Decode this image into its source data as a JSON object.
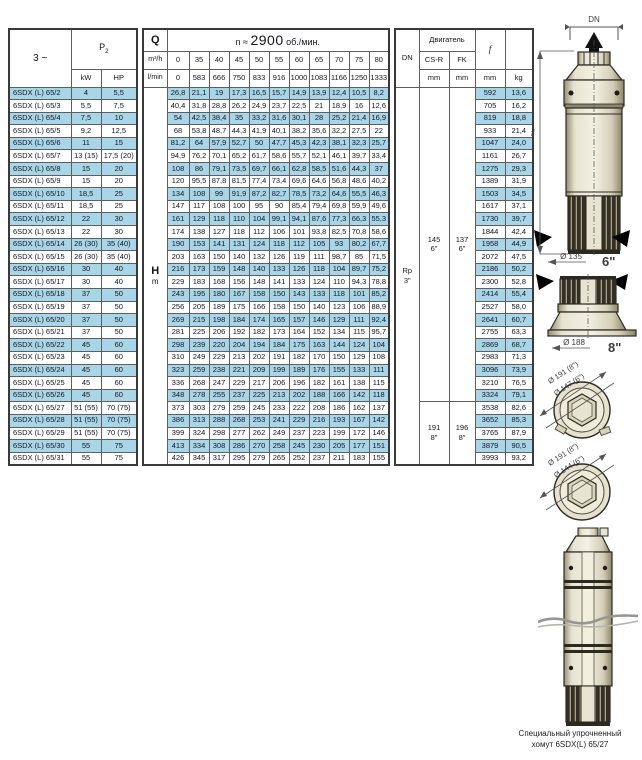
{
  "header": {
    "phase": "3 ~",
    "p2_base": "P",
    "p2_sub": "2",
    "kw": "kW",
    "hp": "HP",
    "q_label": "Q",
    "q_unit_top": "m³/h",
    "q_unit_bottom": "l/min",
    "speed_prefix": "n ≈",
    "speed_value": "2900",
    "speed_suffix": "об./мин.",
    "flow_m3h": [
      "0",
      "35",
      "40",
      "45",
      "50",
      "55",
      "60",
      "65",
      "70",
      "75",
      "80"
    ],
    "flow_lmin": [
      "0",
      "583",
      "666",
      "750",
      "833",
      "916",
      "1000",
      "1083",
      "1166",
      "1250",
      "1333"
    ],
    "dn_label": "DN",
    "motor_label": "Двигатель",
    "csr_label": "CS-R",
    "fk_label": "FK",
    "mm_unit": "mm",
    "f_label": "f",
    "kg_label": "kg"
  },
  "body": {
    "h_label": "H",
    "h_unit": "m",
    "dn_value_line1": "Rp",
    "dn_value_line2": "3\"",
    "csr_6": "145",
    "csr_6_size": "6\"",
    "fk_6": "137",
    "fk_6_size": "6\"",
    "csr_8": "191",
    "csr_8_size": "8\"",
    "fk_8": "196",
    "fk_8_size": "8\""
  },
  "rows": [
    {
      "model": "6SDX (L) 65/2",
      "kw": "4",
      "hp": "5,5",
      "heads": [
        "26,8",
        "21,1",
        "19",
        "17,3",
        "16,5",
        "15,7",
        "14,9",
        "13,9",
        "12,4",
        "10,5",
        "8,2"
      ],
      "f": "592",
      "kg": "13,6"
    },
    {
      "model": "6SDX (L) 65/3",
      "kw": "5,5",
      "hp": "7,5",
      "heads": [
        "40,4",
        "31,8",
        "28,8",
        "26,2",
        "24,9",
        "23,7",
        "22,5",
        "21",
        "18,9",
        "16",
        "12,6"
      ],
      "f": "705",
      "kg": "16,2"
    },
    {
      "model": "6SDX (L) 65/4",
      "kw": "7,5",
      "hp": "10",
      "heads": [
        "54",
        "42,5",
        "38,4",
        "35",
        "33,2",
        "31,6",
        "30,1",
        "28",
        "25,2",
        "21,4",
        "16,9"
      ],
      "f": "819",
      "kg": "18,8"
    },
    {
      "model": "6SDX (L) 65/5",
      "kw": "9,2",
      "hp": "12,5",
      "heads": [
        "68",
        "53,8",
        "48,7",
        "44,3",
        "41,9",
        "40,1",
        "38,2",
        "35,6",
        "32,2",
        "27,5",
        "22"
      ],
      "f": "933",
      "kg": "21,4"
    },
    {
      "model": "6SDX (L) 65/6",
      "kw": "11",
      "hp": "15",
      "heads": [
        "81,2",
        "64",
        "57,9",
        "52,7",
        "50",
        "47,7",
        "45,3",
        "42,3",
        "38,1",
        "32,3",
        "25,7"
      ],
      "f": "1047",
      "kg": "24,0"
    },
    {
      "model": "6SDX (L) 65/7",
      "kw": "13 (15)",
      "hp": "17,5 (20)",
      "heads": [
        "94,9",
        "76,2",
        "70,1",
        "65,2",
        "61,7",
        "58,6",
        "55,7",
        "52,1",
        "46,1",
        "39,7",
        "33,4"
      ],
      "f": "1161",
      "kg": "26,7"
    },
    {
      "model": "6SDX (L) 65/8",
      "kw": "15",
      "hp": "20",
      "heads": [
        "108",
        "86",
        "79,1",
        "73,5",
        "69,7",
        "66,1",
        "62,8",
        "58,5",
        "51,6",
        "44,3",
        "37"
      ],
      "f": "1275",
      "kg": "29,3"
    },
    {
      "model": "6SDX (L) 65/9",
      "kw": "15",
      "hp": "20",
      "heads": [
        "120",
        "95,5",
        "87,8",
        "81,5",
        "77,4",
        "73,4",
        "69,6",
        "64,6",
        "56,8",
        "48,6",
        "40,2"
      ],
      "f": "1389",
      "kg": "31,9"
    },
    {
      "model": "6SDX (L) 65/10",
      "kw": "18,5",
      "hp": "25",
      "heads": [
        "134",
        "108",
        "99",
        "91,9",
        "87,2",
        "82,7",
        "78,5",
        "73,2",
        "64,6",
        "55,5",
        "46,3"
      ],
      "f": "1503",
      "kg": "34,5"
    },
    {
      "model": "6SDX (L) 65/11",
      "kw": "18,5",
      "hp": "25",
      "heads": [
        "147",
        "117",
        "108",
        "100",
        "95",
        "90",
        "85,4",
        "79,4",
        "69,8",
        "59,9",
        "49,6"
      ],
      "f": "1617",
      "kg": "37,1"
    },
    {
      "model": "6SDX (L) 65/12",
      "kw": "22",
      "hp": "30",
      "heads": [
        "161",
        "129",
        "118",
        "110",
        "104",
        "99,1",
        "94,1",
        "87,6",
        "77,3",
        "66,3",
        "55,3"
      ],
      "f": "1730",
      "kg": "39,7"
    },
    {
      "model": "6SDX (L) 65/13",
      "kw": "22",
      "hp": "30",
      "heads": [
        "174",
        "138",
        "127",
        "118",
        "112",
        "106",
        "101",
        "93,8",
        "82,5",
        "70,8",
        "58,6"
      ],
      "f": "1844",
      "kg": "42,4"
    },
    {
      "model": "6SDX (L) 65/14",
      "kw": "26 (30)",
      "hp": "35 (40)",
      "heads": [
        "190",
        "153",
        "141",
        "131",
        "124",
        "118",
        "112",
        "105",
        "93",
        "80,2",
        "67,7"
      ],
      "f": "1958",
      "kg": "44,9"
    },
    {
      "model": "6SDX (L) 65/15",
      "kw": "26 (30)",
      "hp": "35 (40)",
      "heads": [
        "203",
        "163",
        "150",
        "140",
        "132",
        "126",
        "119",
        "111",
        "98,7",
        "85",
        "71,5"
      ],
      "f": "2072",
      "kg": "47,5"
    },
    {
      "model": "6SDX (L) 65/16",
      "kw": "30",
      "hp": "40",
      "heads": [
        "216",
        "173",
        "159",
        "148",
        "140",
        "133",
        "126",
        "118",
        "104",
        "89,7",
        "75,2"
      ],
      "f": "2186",
      "kg": "50,2"
    },
    {
      "model": "6SDX (L) 65/17",
      "kw": "30",
      "hp": "40",
      "heads": [
        "229",
        "183",
        "168",
        "156",
        "148",
        "141",
        "133",
        "124",
        "110",
        "94,3",
        "78,8"
      ],
      "f": "2300",
      "kg": "52,8"
    },
    {
      "model": "6SDX (L) 65/18",
      "kw": "37",
      "hp": "50",
      "heads": [
        "243",
        "195",
        "180",
        "167",
        "158",
        "150",
        "143",
        "133",
        "118",
        "101",
        "85,2"
      ],
      "f": "2414",
      "kg": "55,4"
    },
    {
      "model": "6SDX (L) 65/19",
      "kw": "37",
      "hp": "50",
      "heads": [
        "256",
        "205",
        "189",
        "175",
        "166",
        "158",
        "150",
        "140",
        "123",
        "106",
        "88,9"
      ],
      "f": "2527",
      "kg": "58,0"
    },
    {
      "model": "6SDX (L) 65/20",
      "kw": "37",
      "hp": "50",
      "heads": [
        "269",
        "215",
        "198",
        "184",
        "174",
        "165",
        "157",
        "146",
        "129",
        "111",
        "92,4"
      ],
      "f": "2641",
      "kg": "60,7"
    },
    {
      "model": "6SDX (L) 65/21",
      "kw": "37",
      "hp": "50",
      "heads": [
        "281",
        "225",
        "206",
        "192",
        "182",
        "173",
        "164",
        "152",
        "134",
        "115",
        "95,7"
      ],
      "f": "2755",
      "kg": "63,3"
    },
    {
      "model": "6SDX (L) 65/22",
      "kw": "45",
      "hp": "60",
      "heads": [
        "298",
        "239",
        "220",
        "204",
        "194",
        "184",
        "175",
        "163",
        "144",
        "124",
        "104"
      ],
      "f": "2869",
      "kg": "68,7"
    },
    {
      "model": "6SDX (L) 65/23",
      "kw": "45",
      "hp": "60",
      "heads": [
        "310",
        "249",
        "229",
        "213",
        "202",
        "191",
        "182",
        "170",
        "150",
        "129",
        "108"
      ],
      "f": "2983",
      "kg": "71,3"
    },
    {
      "model": "6SDX (L) 65/24",
      "kw": "45",
      "hp": "60",
      "heads": [
        "323",
        "259",
        "238",
        "221",
        "209",
        "199",
        "189",
        "176",
        "155",
        "133",
        "111"
      ],
      "f": "3096",
      "kg": "73,9"
    },
    {
      "model": "6SDX (L) 65/25",
      "kw": "45",
      "hp": "60",
      "heads": [
        "336",
        "268",
        "247",
        "229",
        "217",
        "206",
        "196",
        "182",
        "161",
        "138",
        "115"
      ],
      "f": "3210",
      "kg": "76,5"
    },
    {
      "model": "6SDX (L) 65/26",
      "kw": "45",
      "hp": "60",
      "heads": [
        "348",
        "278",
        "255",
        "237",
        "225",
        "213",
        "202",
        "188",
        "166",
        "142",
        "118"
      ],
      "f": "3324",
      "kg": "79,1"
    },
    {
      "model": "6SDX (L) 65/27",
      "kw": "51 (55)",
      "hp": "70 (75)",
      "heads": [
        "373",
        "303",
        "279",
        "259",
        "245",
        "233",
        "222",
        "208",
        "186",
        "162",
        "137"
      ],
      "f": "3538",
      "kg": "82,6"
    },
    {
      "model": "6SDX (L) 65/28",
      "kw": "51 (55)",
      "hp": "70 (75)",
      "heads": [
        "386",
        "313",
        "288",
        "268",
        "253",
        "241",
        "229",
        "216",
        "193",
        "167",
        "142"
      ],
      "f": "3652",
      "kg": "85,3"
    },
    {
      "model": "6SDX (L) 65/29",
      "kw": "51 (55)",
      "hp": "70 (75)",
      "heads": [
        "399",
        "324",
        "298",
        "277",
        "262",
        "249",
        "237",
        "223",
        "199",
        "172",
        "146"
      ],
      "f": "3765",
      "kg": "87,9"
    },
    {
      "model": "6SDX (L) 65/30",
      "kw": "55",
      "hp": "75",
      "heads": [
        "413",
        "334",
        "308",
        "286",
        "270",
        "258",
        "245",
        "230",
        "205",
        "177",
        "151"
      ],
      "f": "3879",
      "kg": "90,5"
    },
    {
      "model": "6SDX (L) 65/31",
      "kw": "55",
      "hp": "75",
      "heads": [
        "426",
        "345",
        "317",
        "295",
        "279",
        "265",
        "252",
        "237",
        "211",
        "183",
        "155"
      ],
      "f": "3993",
      "kg": "93,2"
    }
  ],
  "drawings": {
    "dn_dim": "DN",
    "f_dim": "f",
    "dia_135": "Ø 135",
    "size_6": "6\"",
    "dia_188": "Ø 188",
    "size_8": "8\"",
    "circle1_outer": "Ø 191 (8\")",
    "circle1_inner": "Ø 147 (6\")",
    "circle2_outer": "Ø 191 (8\")",
    "circle2_inner": "Ø 144 (6\")",
    "caption_line1": "Специальный упрочненный",
    "caption_line2": "хомут 6SDX(L) 65/27"
  }
}
